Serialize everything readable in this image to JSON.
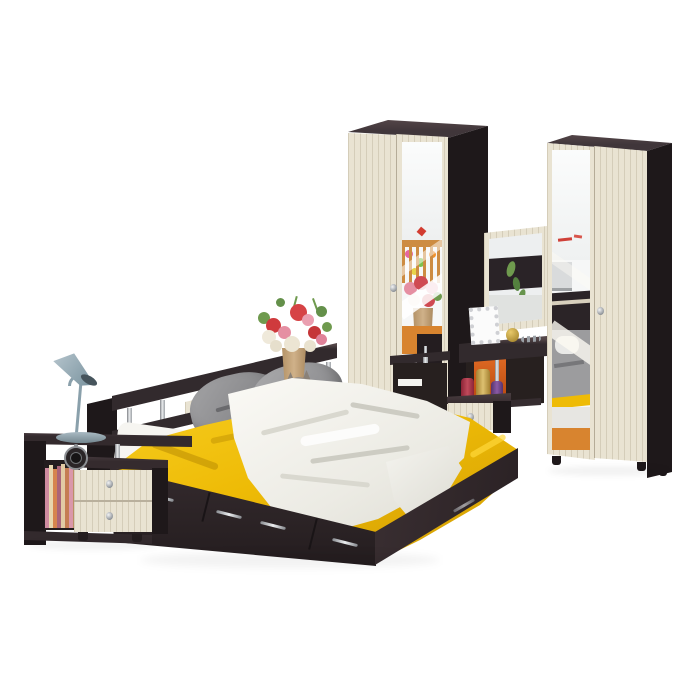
{
  "meta": {
    "type": "product-photo",
    "subject": "bedroom furniture set in wenge and milk oak finish on white background",
    "background": "#ffffff",
    "visible_text": ""
  },
  "palette": {
    "white": "#ffffff",
    "wengeFront": "#322a2d",
    "wengeSide": "#1e181a",
    "wengeTop": "#40363a",
    "wengeDeep": "#27201f",
    "wengeLight": "#544648",
    "cream": "#e9e3d2",
    "creamLine": "#cfc5ae",
    "yellow": "#eebb06",
    "yellowDeep": "#cf9a04",
    "yellowLight": "#f7ce22",
    "throwWhite": "#f6f5f0",
    "throwShadow": "#d9d8cf",
    "pillow": "#9b9b9d",
    "pillowDark": "#77777a",
    "chrome": "#b9bcc1",
    "lampBlue": "#93a6b1",
    "lampBlueDark": "#76909c",
    "floorOrange": "#d8842f",
    "cribWood": "#cd8c42",
    "orangePanel": "#d55e1e",
    "flowerRed": "#cf3a3d",
    "flowerPink": "#e58fa2",
    "flowerCream": "#ece5d3",
    "leafGreen": "#6f9a4e",
    "vaseTan": "#c2a078",
    "catGray": "#948b83",
    "bottleRed": "#a93044",
    "bottleGold": "#c9a348",
    "bottlePurple": "#6d4586",
    "silver": "#cfd0d4",
    "gold": "#caa235"
  },
  "scene": {
    "items": [
      {
        "id": "wardrobe-left",
        "name": "two-door wardrobe with mirror, wenge and milk oak",
        "doors": 2,
        "mirror": true,
        "knobs": 1
      },
      {
        "id": "wardrobe-right",
        "name": "two-door wardrobe with mirror, wenge and milk oak",
        "doors": 2,
        "mirror": true,
        "knobs": 1
      },
      {
        "id": "dressing-table",
        "name": "vanity dressing table with mirror and drawer",
        "drawers": 1,
        "decor": [
          "silver photo frame",
          "gold trinket ball",
          "three perfume bottles",
          "jewelry"
        ]
      },
      {
        "id": "bed",
        "name": "double storage bed with drawers and headboard shelf with chrome posts",
        "drawers": 4,
        "bedding": [
          "yellow bedspread",
          "white crumpled throw",
          "two grey pillows",
          "white sheet"
        ],
        "decor": [
          "flower bouquet in tan vase",
          "grey cat figurine"
        ]
      },
      {
        "id": "nightstand",
        "name": "bedside unit with two drawers, open shelf and books",
        "drawers": 2,
        "decor": [
          "blue-grey desk lamp",
          "black alarm clock",
          "striped books"
        ]
      }
    ],
    "mirror_reflections": {
      "wardrobe_left": [
        "white wall",
        "red wall decal",
        "wooden crib with colorful toys",
        "flower bouquet",
        "orange wooden floor",
        "dark table with chrome leg"
      ],
      "wardrobe_right": [
        "white wall with red marks",
        "grey bedding with pillows",
        "yellow bedspread stripe",
        "dark headboard",
        "orange wooden floor"
      ],
      "vanity": [
        "dark shelf",
        "green plant leaves",
        "light wall"
      ]
    }
  }
}
